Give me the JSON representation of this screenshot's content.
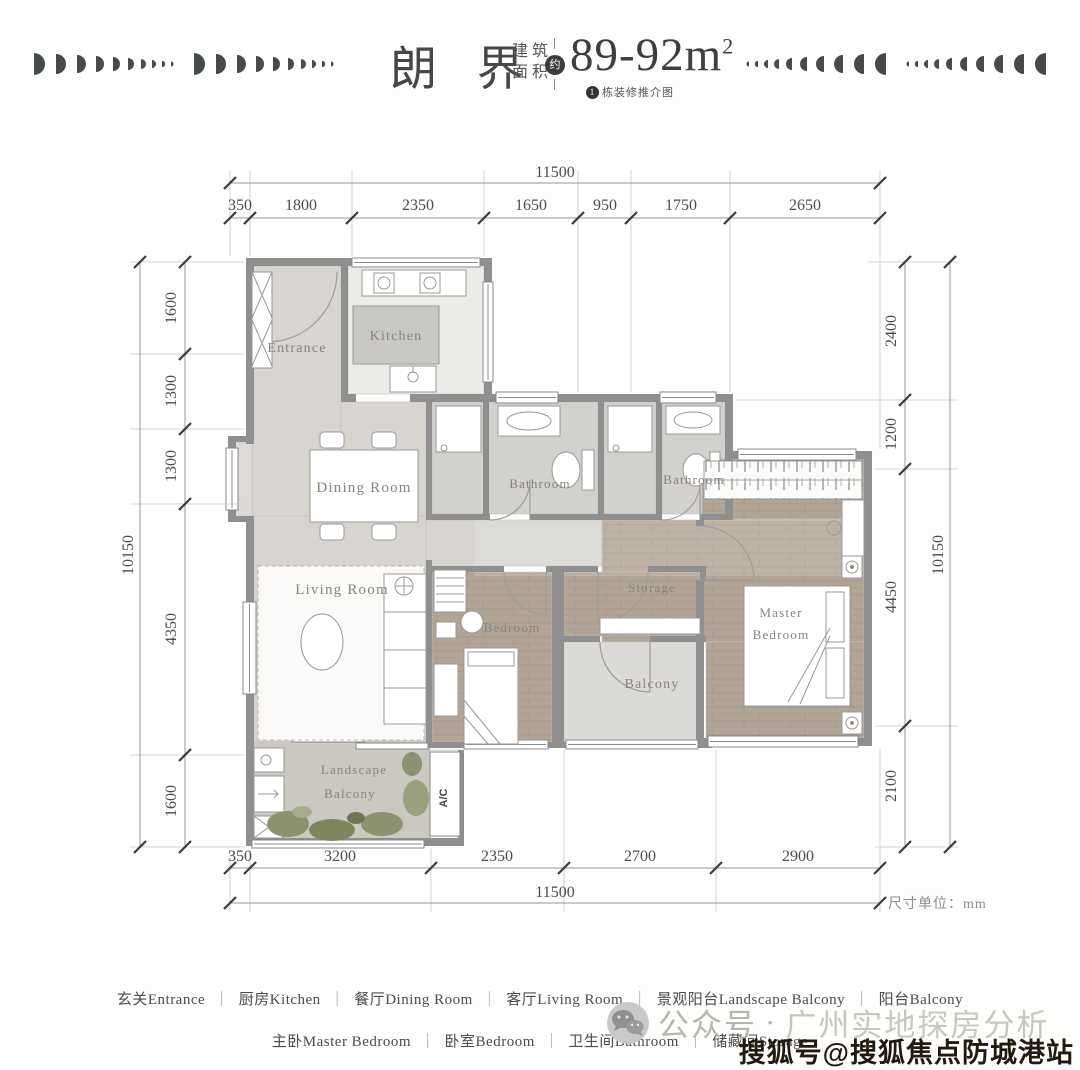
{
  "header": {
    "title": "朗 界",
    "area_label_line1": "建筑",
    "area_label_line2": "面积",
    "approx_badge": "约",
    "area_value": "89-92m",
    "area_superscript": "2",
    "note_badge": "1",
    "note_text": "栋装修推介图"
  },
  "plan": {
    "unit_note": "尺寸单位：mm",
    "rooms": {
      "entrance": "Entrance",
      "kitchen": "Kitchen",
      "dining": "Dining Room",
      "bathroom1": "Bathroom",
      "bathroom2": "Bathroom",
      "living": "Living Room",
      "bedroom": "Bedroom",
      "storage": "Storage",
      "balcony": "Balcony",
      "master_line1": "Master",
      "master_line2": "Bedroom",
      "landscape_line1": "Landscape",
      "landscape_line2": "Balcony",
      "ac": "A/C"
    },
    "dimensions": {
      "top": {
        "total": "11500",
        "segments": [
          "350",
          "1800",
          "2350",
          "1650",
          "950",
          "1750",
          "2650"
        ]
      },
      "bottom": {
        "total": "11500",
        "segments": [
          "350",
          "3200",
          "2350",
          "2700",
          "2900"
        ]
      },
      "left": {
        "total": "10150",
        "segments": [
          "1600",
          "1300",
          "1300",
          "4350",
          "1600"
        ]
      },
      "right": {
        "total": "10150",
        "segments": [
          "2400",
          "1200",
          "4450",
          "2100"
        ]
      }
    }
  },
  "legend": {
    "separator": "｜",
    "row1": [
      "玄关Entrance",
      "厨房Kitchen",
      "餐厅Dining Room",
      "客厅Living Room",
      "景观阳台Landscape Balcony",
      "阳台Balcony"
    ],
    "row2": [
      "主卧Master Bedroom",
      "卧室Bedroom",
      "卫生间Bathroom",
      "储藏间Storage"
    ]
  },
  "watermarks": {
    "wechat_prefix": "公众号",
    "wechat_dot": "·",
    "wechat_name": "广州实地探房分析",
    "sohu": "搜狐号@搜狐焦点防城港站"
  },
  "colors": {
    "wall": "#8f8f8f",
    "marble_floor": "#d8d5d1",
    "wood_floor": "#b3a596",
    "bath_floor": "#d3d1ce",
    "balcony_floor": "#dcdad7",
    "landscape_floor": "#cac8c0",
    "plant": "#8b926f",
    "badge_dark": "#3d3d3d",
    "dimension_text": "#4c4c4c"
  }
}
